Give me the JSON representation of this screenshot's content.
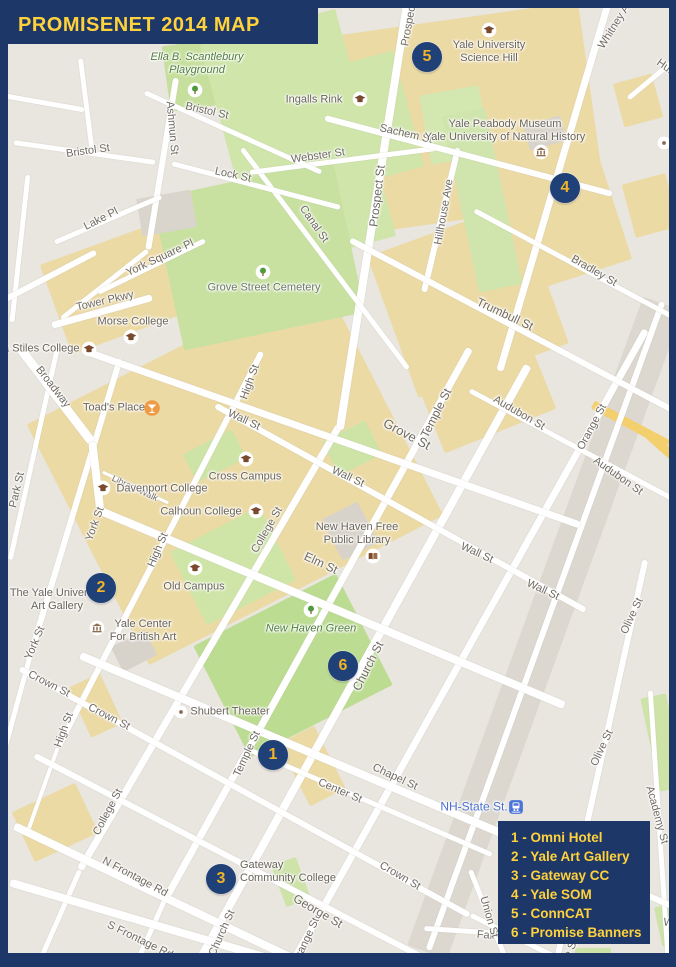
{
  "title": "PROMISENET 2014 MAP",
  "colors": {
    "navy": "#1d3768",
    "marker_navy": "#1f4177",
    "gold": "#ffd23c",
    "marker_gold": "#f0b429",
    "transit_blue": "#4a6fd1",
    "map_base": "#e9e5df",
    "campus_tan": "#ecdaa5",
    "park_green": "#c9e2a0",
    "road_white": "#ffffff"
  },
  "legend": {
    "items": [
      {
        "text": "1 - Omni Hotel"
      },
      {
        "text": "2 - Yale Art Gallery"
      },
      {
        "text": "3 - Gateway CC"
      },
      {
        "text": "4 - Yale SOM"
      },
      {
        "text": "5 - ConnCAT"
      },
      {
        "text": "6 - Promise Banners"
      }
    ]
  },
  "map": {
    "areas": [
      [
        235,
        470,
        330,
        270,
        -27,
        "#ecdaa5"
      ],
      [
        468,
        118,
        250,
        200,
        -8,
        "#ecdaa5"
      ],
      [
        468,
        300,
        160,
        150,
        -20,
        "#ecdaa5"
      ],
      [
        150,
        275,
        200,
        95,
        -20,
        "#ecdaa5"
      ],
      [
        480,
        380,
        120,
        110,
        -22,
        "#ecdaa5"
      ],
      [
        55,
        822,
        70,
        55,
        -25,
        "#ecdaa5"
      ],
      [
        312,
        766,
        40,
        70,
        -27,
        "#ecdaa5"
      ],
      [
        556,
        212,
        115,
        135,
        -18,
        "#ecdaa5"
      ],
      [
        650,
        205,
        45,
        55,
        -15,
        "#ecdaa5"
      ],
      [
        638,
        100,
        40,
        45,
        -15,
        "#ecdaa5"
      ],
      [
        95,
        705,
        35,
        55,
        -25,
        "#ecdaa5"
      ],
      [
        195,
        75,
        58,
        66,
        -8,
        "#c6df9c"
      ],
      [
        298,
        140,
        140,
        235,
        -15,
        "#cfe5aa"
      ],
      [
        365,
        120,
        90,
        120,
        -15,
        "#cfe5aa"
      ],
      [
        455,
        125,
        60,
        70,
        -10,
        "#d3e7b0"
      ],
      [
        258,
        255,
        185,
        155,
        -12,
        "#c8e1a1"
      ],
      [
        482,
        200,
        44,
        180,
        -12,
        "#cfe5ad"
      ],
      [
        352,
        448,
        48,
        38,
        -27,
        "#cde4a6"
      ],
      [
        214,
        456,
        55,
        32,
        -27,
        "#cde4a6"
      ],
      [
        233,
        566,
        100,
        82,
        -27,
        "#cfe5a8"
      ],
      [
        293,
        665,
        160,
        125,
        -27,
        "#bcdc92"
      ],
      [
        663,
        742,
        26,
        95,
        -12,
        "#cde3a8"
      ],
      [
        291,
        882,
        26,
        44,
        -20,
        "#cde3a8"
      ],
      [
        593,
        957,
        36,
        18,
        0,
        "#cde3a8"
      ],
      [
        668,
        925,
        20,
        40,
        -12,
        "#cde3a8"
      ],
      [
        166,
        213,
        55,
        38,
        -10,
        "#dad5cc"
      ],
      [
        350,
        531,
        40,
        46,
        -27,
        "#d8d3ca"
      ],
      [
        134,
        651,
        38,
        28,
        -27,
        "#d8d3ca"
      ],
      [
        545,
        133,
        38,
        26,
        -15,
        "#d8d3ca"
      ],
      [
        545,
        628,
        690,
        42,
        110,
        "#dcd8d0"
      ],
      [
        630,
        424,
        85,
        9,
        28,
        "#f4cf6e"
      ],
      [
        668,
        452,
        55,
        9,
        42,
        "#f4cf6e"
      ]
    ],
    "roads": [
      [
        120,
        358,
        30,
        655,
        6
      ],
      [
        30,
        655,
        2,
        758,
        5
      ],
      [
        58,
        345,
        10,
        560,
        5
      ],
      [
        262,
        352,
        58,
        748,
        6
      ],
      [
        58,
        748,
        28,
        832,
        4
      ],
      [
        340,
        425,
        80,
        870,
        7
      ],
      [
        80,
        870,
        38,
        965,
        5
      ],
      [
        470,
        348,
        165,
        900,
        7
      ],
      [
        165,
        900,
        135,
        967,
        5
      ],
      [
        528,
        365,
        198,
        962,
        8
      ],
      [
        608,
        4,
        500,
        370,
        7
      ],
      [
        646,
        330,
        290,
        967,
        7
      ],
      [
        662,
        302,
        428,
        950,
        6
      ],
      [
        645,
        560,
        556,
        962,
        6
      ],
      [
        650,
        690,
        668,
        962,
        5
      ],
      [
        408,
        0,
        340,
        430,
        8
      ],
      [
        458,
        148,
        424,
        292,
        6
      ],
      [
        176,
        78,
        148,
        250,
        6
      ],
      [
        148,
        250,
        62,
        318,
        5
      ],
      [
        242,
        148,
        408,
        368,
        5
      ],
      [
        172,
        163,
        340,
        207,
        5
      ],
      [
        470,
        870,
        508,
        965,
        5
      ],
      [
        250,
        172,
        436,
        148,
        5
      ],
      [
        145,
        92,
        322,
        172,
        5
      ],
      [
        14,
        142,
        156,
        162,
        5
      ],
      [
        55,
        242,
        162,
        196,
        5
      ],
      [
        98,
        292,
        205,
        240,
        5
      ],
      [
        52,
        325,
        152,
        297,
        7
      ],
      [
        20,
        348,
        92,
        442,
        9
      ],
      [
        92,
        442,
        100,
        510,
        8
      ],
      [
        325,
        118,
        612,
        194,
        6
      ],
      [
        628,
        98,
        676,
        58,
        5
      ],
      [
        475,
        210,
        676,
        318,
        5
      ],
      [
        350,
        240,
        676,
        412,
        6
      ],
      [
        88,
        352,
        580,
        525,
        7
      ],
      [
        215,
        405,
        585,
        610,
        6
      ],
      [
        100,
        510,
        565,
        705,
        8
      ],
      [
        80,
        655,
        556,
        856,
        8
      ],
      [
        556,
        856,
        676,
        908,
        6
      ],
      [
        20,
        668,
        470,
        915,
        6
      ],
      [
        470,
        915,
        565,
        962,
        5
      ],
      [
        245,
        748,
        492,
        855,
        5
      ],
      [
        35,
        755,
        452,
        972,
        6
      ],
      [
        424,
        928,
        582,
        938,
        5
      ],
      [
        14,
        826,
        300,
        962,
        8
      ],
      [
        10,
        882,
        300,
        967,
        8
      ],
      [
        470,
        390,
        676,
        500,
        5
      ],
      [
        102,
        472,
        168,
        503,
        3
      ],
      [
        28,
        175,
        12,
        322,
        5
      ],
      [
        0,
        95,
        85,
        110,
        5
      ],
      [
        80,
        58,
        92,
        152,
        5
      ],
      [
        0,
        302,
        96,
        252,
        6
      ]
    ],
    "street_labels": [
      [
        "Webster St",
        318,
        156,
        -8
      ],
      [
        "Bristol St",
        207,
        111,
        13
      ],
      [
        "Bristol St",
        88,
        151,
        -8
      ],
      [
        "Ashmun St",
        172,
        128,
        85
      ],
      [
        "Lake Pl",
        101,
        219,
        -27
      ],
      [
        "York Square Pl",
        160,
        258,
        -25
      ],
      [
        "Tower Pkwy",
        105,
        301,
        -13
      ],
      [
        "Broadway",
        53,
        387,
        52
      ],
      [
        "Lock St",
        233,
        175,
        12
      ],
      [
        "Canal St",
        314,
        224,
        55
      ],
      [
        "Prospect St",
        377,
        196,
        -83,
        12
      ],
      [
        "Prospect St",
        410,
        18,
        -80
      ],
      [
        "Hillhouse Ave",
        444,
        212,
        -80
      ],
      [
        "Sachem St",
        406,
        134,
        13
      ],
      [
        "Whitney Ave",
        617,
        22,
        -58
      ],
      [
        "Humphrey St",
        684,
        80,
        35
      ],
      [
        "Grove St",
        407,
        434,
        28,
        13
      ],
      [
        "Trumbull St",
        505,
        314,
        25,
        12
      ],
      [
        "Trumbull St",
        690,
        430,
        50
      ],
      [
        "Bradley St",
        594,
        271,
        30
      ],
      [
        "Audubon St",
        519,
        413,
        30
      ],
      [
        "Audubon St",
        618,
        476,
        35
      ],
      [
        "Orange St",
        592,
        427,
        -62
      ],
      [
        "Orange St",
        306,
        941,
        -65
      ],
      [
        "Temple St",
        436,
        413,
        -63,
        12
      ],
      [
        "Temple St",
        247,
        754,
        -65
      ],
      [
        "Church St",
        368,
        666,
        -63,
        12
      ],
      [
        "Church St",
        222,
        933,
        -66
      ],
      [
        "College St",
        267,
        530,
        -60
      ],
      [
        "College St",
        108,
        812,
        -62
      ],
      [
        "High St",
        250,
        382,
        -70
      ],
      [
        "High St",
        158,
        550,
        -67
      ],
      [
        "High St",
        64,
        730,
        -70
      ],
      [
        "York St",
        95,
        524,
        -70
      ],
      [
        "York St",
        35,
        643,
        -67
      ],
      [
        "Park St",
        17,
        490,
        -77
      ],
      [
        "Wall St",
        244,
        420,
        25
      ],
      [
        "Wall St",
        348,
        477,
        25
      ],
      [
        "Wall St",
        477,
        553,
        25
      ],
      [
        "Wall St",
        543,
        590,
        25
      ],
      [
        "Elm St",
        321,
        563,
        25,
        12
      ],
      [
        "Crown St",
        49,
        684,
        27
      ],
      [
        "Crown St",
        109,
        717,
        27
      ],
      [
        "Crown St",
        400,
        876,
        30
      ],
      [
        "Center St",
        340,
        791,
        23
      ],
      [
        "Chapel St",
        395,
        777,
        25
      ],
      [
        "George St",
        318,
        911,
        30,
        12
      ],
      [
        "N Frontage Rd",
        135,
        877,
        28
      ],
      [
        "S Frontage Rd",
        140,
        940,
        26
      ],
      [
        "Fair St",
        493,
        936,
        5
      ],
      [
        "Union St",
        489,
        917,
        74
      ],
      [
        "Olive St",
        632,
        616,
        -65
      ],
      [
        "Olive St",
        602,
        748,
        -65
      ],
      [
        "Olive St",
        567,
        957,
        -65
      ],
      [
        "Academy St",
        657,
        815,
        75
      ],
      [
        "Wooster Pl",
        690,
        926,
        8
      ],
      [
        "Library Walk",
        135,
        488,
        25,
        9
      ]
    ],
    "places": [
      {
        "t": "Ella B. Scantlebury\nPlayground",
        "x": 197,
        "y": 64,
        "s": "park",
        "icon": "tree-icon",
        "ix": 195,
        "iy": 90
      },
      {
        "t": "Ingalls Rink",
        "x": 314,
        "y": 100,
        "icon": "graduation-cap-icon",
        "ix": 360,
        "iy": 99
      },
      {
        "t": "Yale University\nScience Hill",
        "x": 489,
        "y": 52,
        "icon": "graduation-cap-icon",
        "ix": 489,
        "iy": 30
      },
      {
        "t": "Yale Peabody Museum\nYale University of Natural History",
        "x": 505,
        "y": 131,
        "icon": "museum-icon",
        "ix": 541,
        "iy": 152
      },
      {
        "t": "Grove Street Cemetery",
        "x": 264,
        "y": 288,
        "s": "cemetery",
        "icon": "tree-icon",
        "ix": 263,
        "iy": 272
      },
      {
        "t": "Morse College",
        "x": 133,
        "y": 322,
        "icon": "graduation-cap-icon",
        "ix": 131,
        "iy": 337
      },
      {
        "t": "Ezra Stiles College",
        "x": 33,
        "y": 349,
        "icon": "graduation-cap-icon",
        "ix": 89,
        "iy": 349
      },
      {
        "t": "Toad's Place",
        "x": 114,
        "y": 408,
        "icon": "cocktail-icon",
        "ix": 152,
        "iy": 408
      },
      {
        "t": "Cross Campus",
        "x": 245,
        "y": 477,
        "icon": "graduation-cap-icon",
        "ix": 246,
        "iy": 459
      },
      {
        "t": "Davenport College",
        "x": 162,
        "y": 489,
        "icon": "graduation-cap-icon",
        "ix": 103,
        "iy": 488
      },
      {
        "t": "Calhoun College",
        "x": 201,
        "y": 512,
        "icon": "graduation-cap-icon",
        "ix": 256,
        "iy": 511
      },
      {
        "t": "Old Campus",
        "x": 194,
        "y": 587,
        "icon": "graduation-cap-icon",
        "ix": 195,
        "iy": 568
      },
      {
        "t": "The Yale University\nArt Gallery",
        "x": 57,
        "y": 600
      },
      {
        "t": "Yale Center\nFor British Art",
        "x": 143,
        "y": 631,
        "icon": "museum-icon",
        "ix": 97,
        "iy": 628
      },
      {
        "t": "New Haven Free\nPublic Library",
        "x": 357,
        "y": 534,
        "icon": "book-icon",
        "ix": 373,
        "iy": 556
      },
      {
        "t": "New Haven Green",
        "x": 311,
        "y": 629,
        "s": "park",
        "icon": "tree-icon",
        "ix": 311,
        "iy": 610
      },
      {
        "t": "Shubert Theater",
        "x": 230,
        "y": 712,
        "icon": "dot-icon",
        "ix": 181,
        "iy": 712
      },
      {
        "t": "Gateway\nCommunity College",
        "x": 293,
        "y": 872,
        "align": "left",
        "lx": 240
      },
      {
        "t": "NH-State St.",
        "x": 474,
        "y": 807,
        "s": "transit",
        "icon": "train-icon",
        "ix": 516,
        "iy": 807
      },
      {
        "t": "",
        "x": 664,
        "y": 143,
        "icon": "dot-icon",
        "ix": 664,
        "iy": 143
      }
    ],
    "markers": [
      {
        "n": "1",
        "x": 273,
        "y": 755
      },
      {
        "n": "2",
        "x": 101,
        "y": 588
      },
      {
        "n": "3",
        "x": 221,
        "y": 879
      },
      {
        "n": "4",
        "x": 565,
        "y": 188
      },
      {
        "n": "5",
        "x": 427,
        "y": 57
      },
      {
        "n": "6",
        "x": 343,
        "y": 666
      }
    ]
  }
}
